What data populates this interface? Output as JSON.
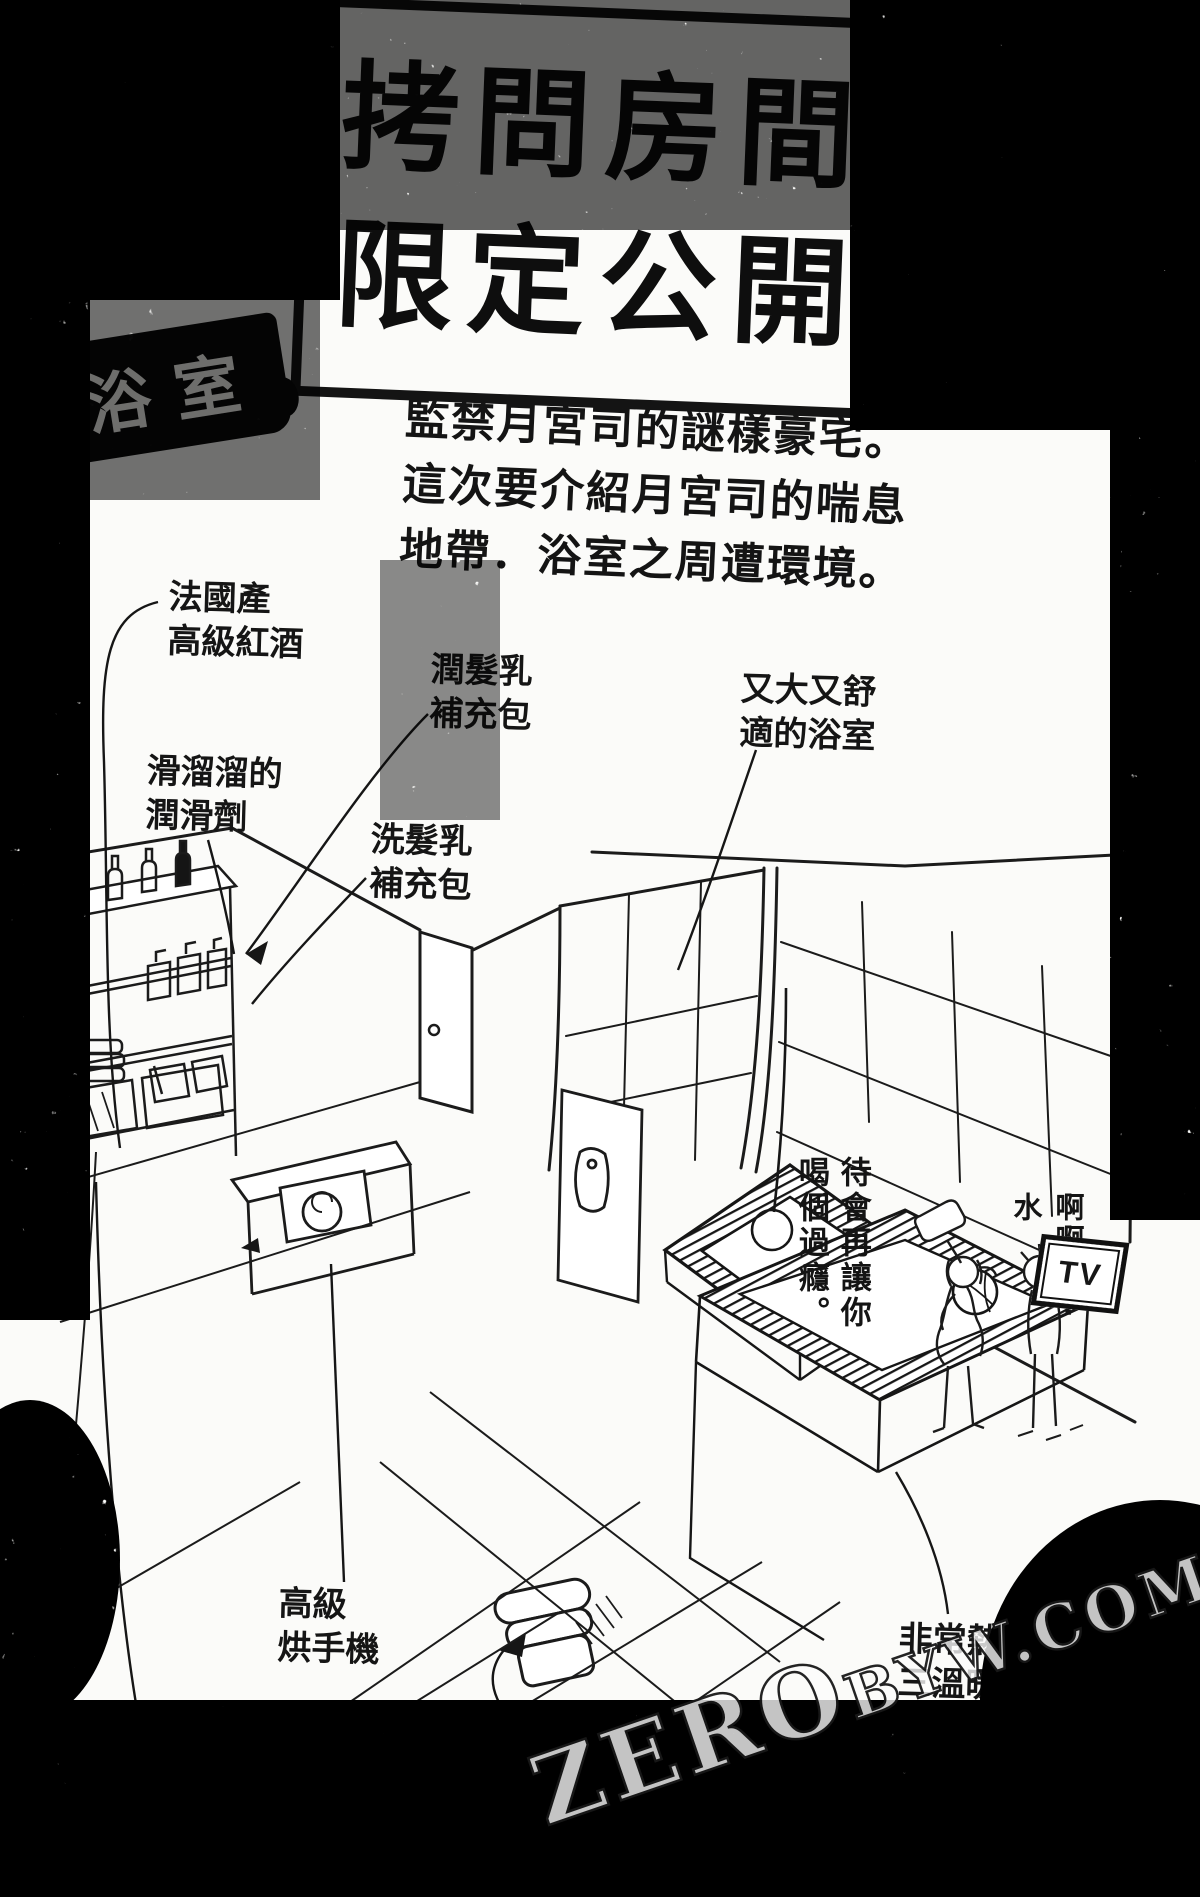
{
  "page": {
    "title_line1": "拷問房間",
    "title_line2": "限定公開!",
    "room_label": "浴室",
    "intro_lines": [
      "監禁月宮司的謎樣豪宅。",
      "這次要介紹月宮司的喘息",
      "地帶．浴室之周遭環境。"
    ]
  },
  "annotations": [
    {
      "item": "wine",
      "lines": [
        "法國產",
        "高級紅酒"
      ]
    },
    {
      "item": "conditioner",
      "lines": [
        "潤髮乳",
        "補充包"
      ]
    },
    {
      "item": "lube",
      "lines": [
        "滑溜溜的",
        "潤滑劑"
      ]
    },
    {
      "item": "shampoo",
      "lines": [
        "洗髮乳",
        "補充包"
      ]
    },
    {
      "item": "bathroom",
      "lines": [
        "又大又舒",
        "適的浴室"
      ]
    },
    {
      "item": "hand-dryer",
      "lines": [
        "高級",
        "烘手機"
      ]
    },
    {
      "item": "towel",
      "lines": [
        "非常柔軟",
        "的浴巾"
      ]
    },
    {
      "item": "bidet-seat",
      "lines": [
        "免治馬桶座",
        "被牢牢固定"
      ]
    },
    {
      "item": "sauna",
      "lines": [
        "非常熱的",
        "三溫暖"
      ]
    }
  ],
  "speech": {
    "columns": [
      "待會再讓你",
      "喝個過癮。"
    ],
    "gasp": "啊啊⋯⋯水",
    "tv_label": "TV"
  },
  "watermark": {
    "zero": "ZERO",
    "rest": "BYW.COM"
  },
  "colors": {
    "ink": "#141414",
    "paper": "#fbfbf9",
    "sticker": "#0b0b0b"
  }
}
